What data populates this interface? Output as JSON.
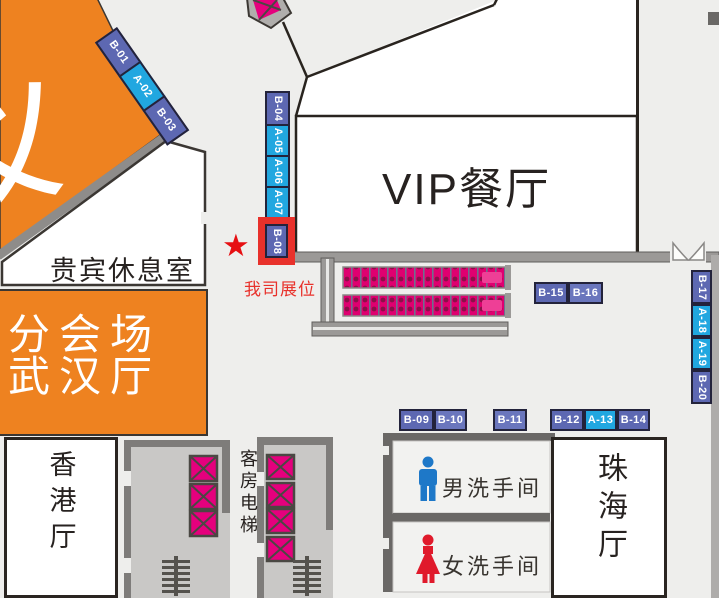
{
  "rooms": {
    "vip_restaurant": "VIP餐厅",
    "vip_lounge": "贵宾休息室",
    "branch_venue": {
      "line1": "分会场",
      "line2": "武汉厅"
    },
    "hongkong_hall": "香港厅",
    "zhuhai_hall": "珠海厅",
    "mens_restroom": "男洗手间",
    "womens_restroom": "女洗手间",
    "guest_elevator": "客房电梯",
    "corner_partial_text": "义"
  },
  "booths": {
    "diagonal": [
      {
        "id": "B-01",
        "type": "B"
      },
      {
        "id": "A-02",
        "type": "A"
      },
      {
        "id": "B-03",
        "type": "B"
      }
    ],
    "left_column": [
      {
        "id": "B-04",
        "type": "B"
      },
      {
        "id": "A-05",
        "type": "A"
      },
      {
        "id": "A-06",
        "type": "A"
      },
      {
        "id": "A-07",
        "type": "A"
      }
    ],
    "highlighted": {
      "id": "B-08",
      "type": "B"
    },
    "center": [
      {
        "id": "B-15",
        "type": "B"
      },
      {
        "id": "B-16",
        "type": "B"
      }
    ],
    "right_column": [
      {
        "id": "B-17",
        "type": "B"
      },
      {
        "id": "A-18",
        "type": "A"
      },
      {
        "id": "A-19",
        "type": "A"
      },
      {
        "id": "B-20",
        "type": "B"
      }
    ],
    "bottom_row": [
      {
        "id": "B-09",
        "type": "B"
      },
      {
        "id": "B-10",
        "type": "B"
      },
      {
        "id": "B-11",
        "type": "B"
      },
      {
        "id": "B-12",
        "type": "B"
      },
      {
        "id": "A-13",
        "type": "A"
      },
      {
        "id": "B-14",
        "type": "B"
      }
    ]
  },
  "annotations": {
    "star": "★",
    "our_booth_label": "我司展位"
  },
  "colors": {
    "booth_type_a": "#21a7e0",
    "booth_type_b": "#5d68b2",
    "highlight_red": "#e8312b",
    "orange_hall": "#ee8220",
    "walkway_magenta": "#e5007d",
    "man_icon_blue": "#1e78c8",
    "woman_icon_red": "#e01a2b",
    "wall_gray": "#9b9997",
    "background": "#eeeeec"
  }
}
